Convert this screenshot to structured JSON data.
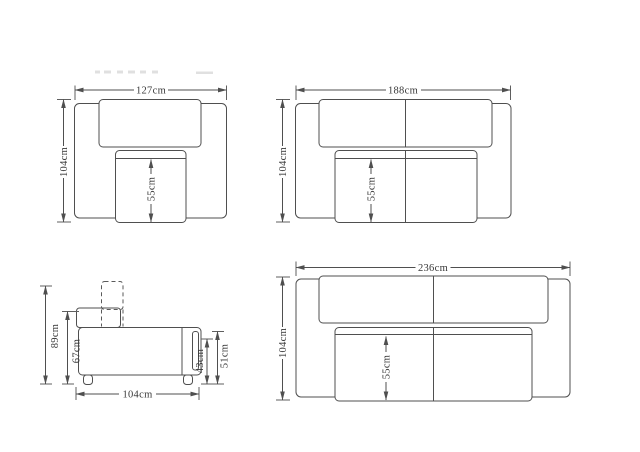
{
  "drawing": {
    "background": "#ffffff",
    "line_color": "#4f4f4f",
    "text_color": "#383838",
    "views": {
      "armchair_top": {
        "width": "127cm",
        "depth": "104cm",
        "seat_depth": "55cm"
      },
      "loveseat_top": {
        "width": "188cm",
        "depth": "104cm",
        "seat_depth": "55cm"
      },
      "sofa_side": {
        "overall_height": "89cm",
        "back_height": "67cm",
        "depth": "104cm",
        "seat_front_height": "43cm",
        "arm_height": "51cm"
      },
      "sofa_top": {
        "width": "236cm",
        "depth": "104cm",
        "seat_depth": "55cm"
      }
    }
  }
}
